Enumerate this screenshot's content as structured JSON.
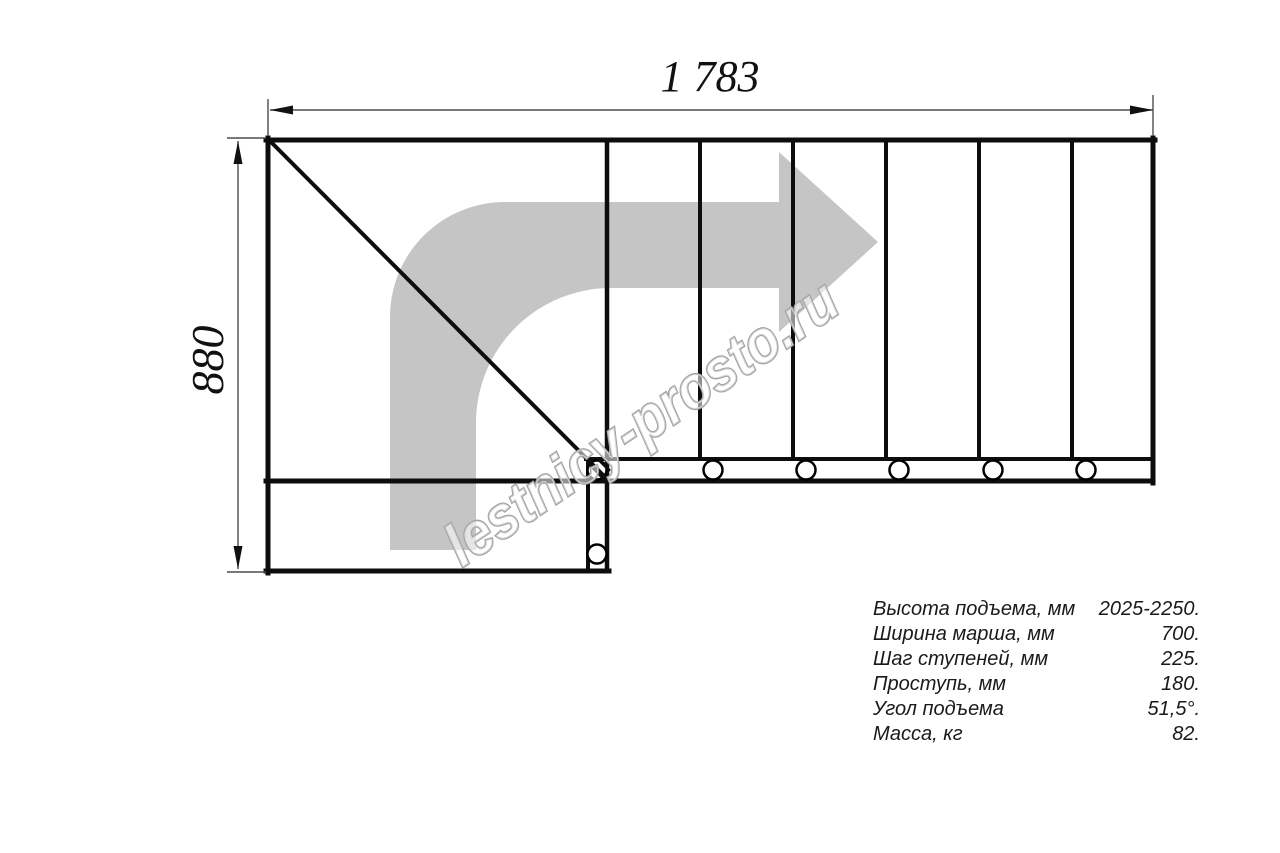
{
  "drawing": {
    "type": "staircase-plan-top-view",
    "dimensions": {
      "width_label": "1 783",
      "height_label": "880"
    },
    "watermark": {
      "text": "lestnicy-prosto.ru"
    },
    "specs": {
      "rows": [
        {
          "label": "Высота подъема, мм",
          "value": "2025-2250."
        },
        {
          "label": "Ширина марша, мм",
          "value": "700."
        },
        {
          "label": "Шаг ступеней, мм",
          "value": "225."
        },
        {
          "label": "Проступь, мм",
          "value": "180."
        },
        {
          "label": "Угол подъема",
          "value": "51,5°."
        },
        {
          "label": "Масса, кг",
          "value": "82."
        }
      ]
    },
    "colors": {
      "line": "#0d0d0d",
      "dimension_line": "#4d4d4d",
      "arrow_fill": "#c5c5c5",
      "watermark_stroke": "#9f9f9f",
      "background": "#ffffff"
    }
  }
}
